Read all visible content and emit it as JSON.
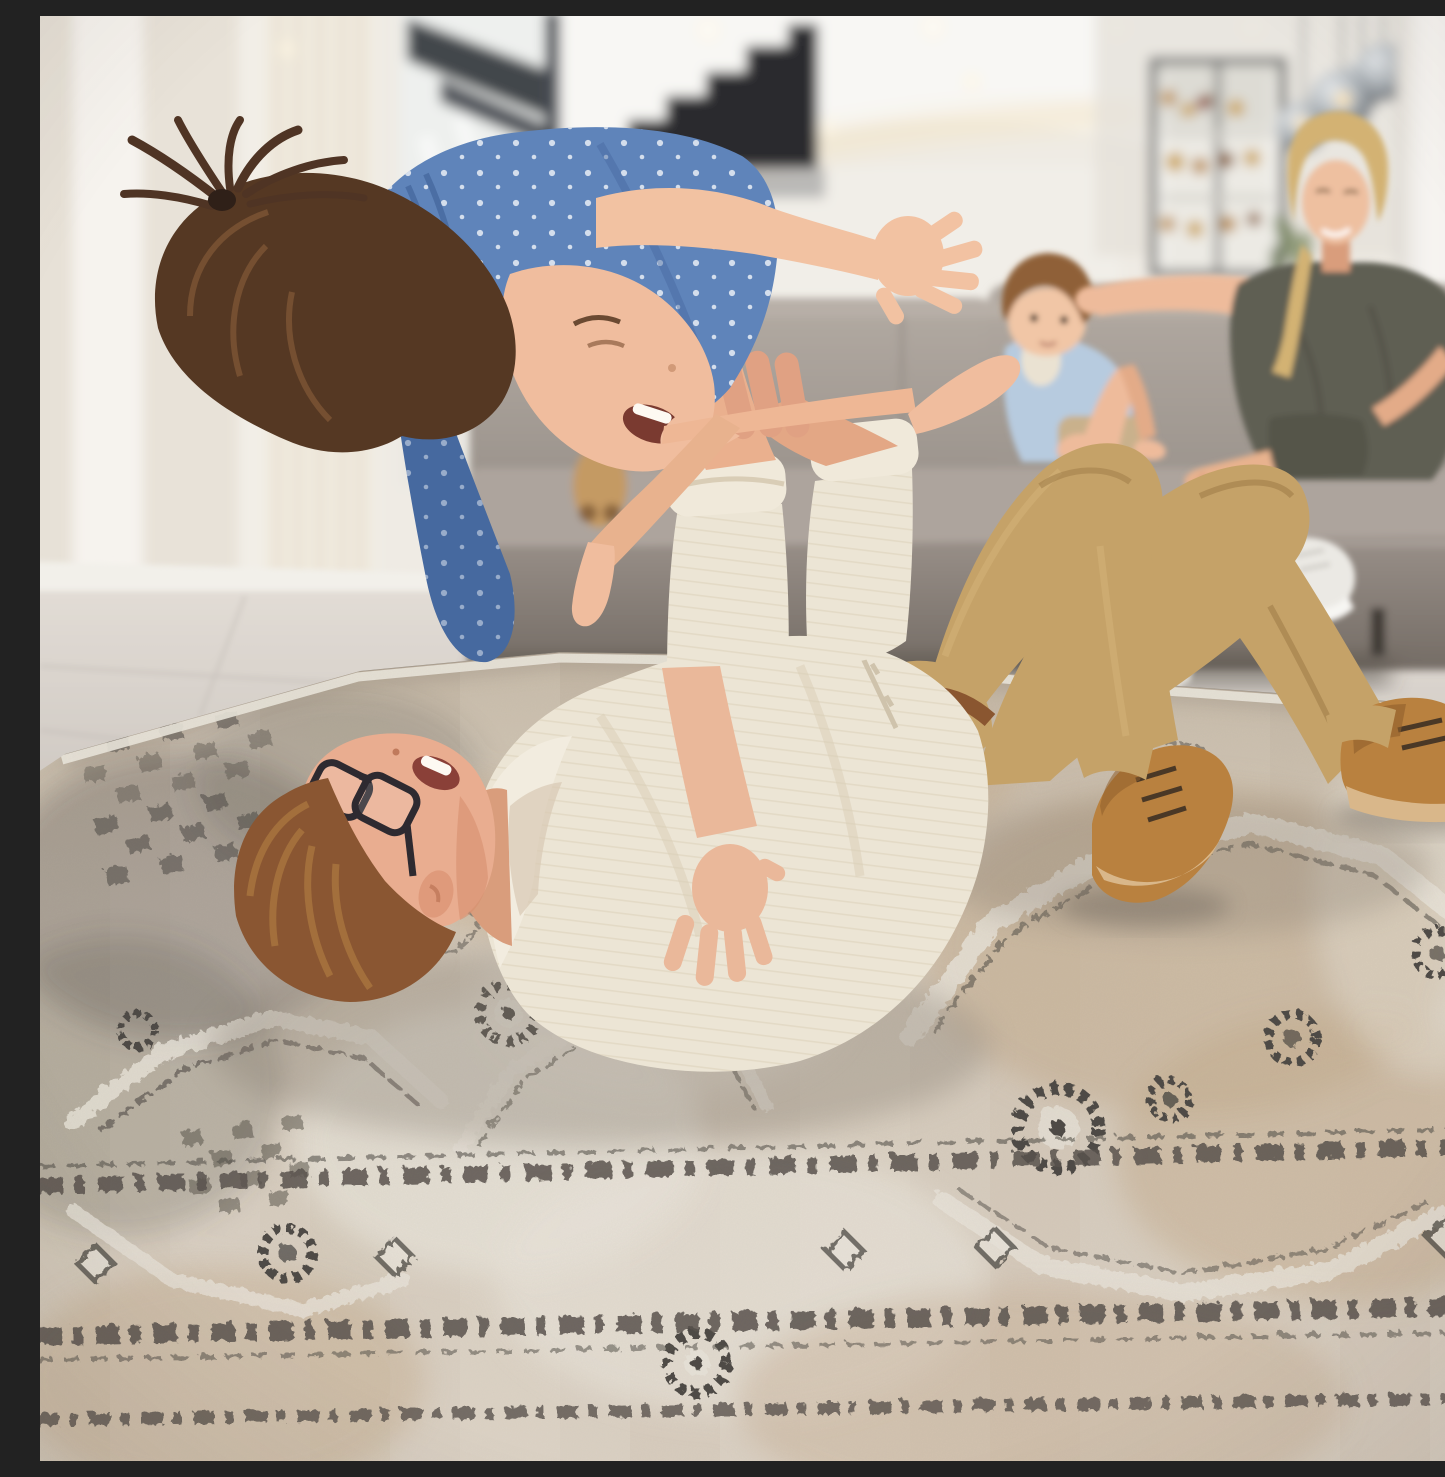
{
  "scene": {
    "kind": "lifestyle product photograph",
    "subject": "vintage-style beige and grey oriental area rug in a bright modern living room",
    "foreground": "father lying on his back on the rug lifting his laughing daughter in the air airplane-style",
    "background": "mother and toddler with a teddy bear sitting on a grey sofa, glass bar cabinet with bottles, smoked-glass pendant lamps, floating dark staircase, sheer curtains, white pillar",
    "elements": [
      {
        "name": "area-rug",
        "desc": "distressed beige/taupe rug with charcoal rosette and medallion motifs and dashed border bands"
      },
      {
        "name": "father",
        "desc": "man with auburn hair and dark glasses, cream striped shirt, khaki chinos, tan suede boots"
      },
      {
        "name": "daughter",
        "desc": "girl in blue floral romper with brown ponytail, arms outstretched"
      },
      {
        "name": "mother",
        "desc": "blonde woman in olive dress with white sneakers on grey sofa"
      },
      {
        "name": "toddler",
        "desc": "little boy in light blue shirt hugging a white teddy bear"
      },
      {
        "name": "pendant-lights",
        "desc": "cluster of smoked glass globe pendants with warm filament bulbs"
      },
      {
        "name": "bar-cabinet",
        "desc": "dark framed glass cabinet with amber liquor bottles"
      },
      {
        "name": "staircase",
        "desc": "dark floating staircase silhouette"
      },
      {
        "name": "sofa",
        "desc": "grey-taupe fabric corner sofa"
      },
      {
        "name": "teddy-bear-tan",
        "desc": "tan plush bear on sofa"
      }
    ]
  },
  "colors": {
    "wall": "#efebe4",
    "wall_shade": "#e6e0d7",
    "wall_bright": "#f6f3ee",
    "ceiling": "#f8f7f4",
    "cove_glow": "#f3e6cd",
    "curtain": "#f1ebdf",
    "stairs": "#2a2b2f",
    "window_frame": "#42464c",
    "floor": "#dbd5ce",
    "floor_dark": "#c7c1bb",
    "baseboard": "#f2f0ea",
    "pillar": "#f5f3ef",
    "cabinet_frame": "#595a5c",
    "bottle_amber": "#b9883c",
    "bottle_gold": "#caa24e",
    "bottle_red": "#8d3a34",
    "plant": "#7d8a66",
    "pendant_dark": "#5f6468",
    "filament": "#f2c16b",
    "sofa": "#a59d96",
    "sofa_light": "#b7afa7",
    "sofa_dark": "#8b837c",
    "sofa_shadow": "#575149",
    "teddy_tan": "#c49a63",
    "teddy_white": "#eae2d2",
    "boy_hair": "#8f6038",
    "boy_shirt": "#b7cbdf",
    "boy_shorts": "#c9b18c",
    "mother_hair": "#d3b273",
    "mother_dress": "#5f5e53",
    "sneaker": "#ebe9e4",
    "skin": "#eebb9b",
    "skin_deep": "#d99d7c",
    "dad_hair": "#8a5632",
    "dad_shirt": "#ece5d5",
    "shirt_stripe": "#d6c9af",
    "dad_pants": "#c5a268",
    "pants_shadow": "#a07d49",
    "belt": "#8a5630",
    "boot": "#b9813f",
    "boot_dark": "#8f5f2c",
    "glasses": "#2e2a30",
    "girl_hair": "#553823",
    "girl_dress": "#5f84ba",
    "dress_shadow": "#46699f",
    "dress_dot": "#e9eef5",
    "rug_base": "#d3c7b8",
    "rug_tan": "#c3ab8e",
    "rug_cream": "#e7e2d8",
    "rug_charcoal": "#4e4a45",
    "rug_border": "#57524c"
  }
}
